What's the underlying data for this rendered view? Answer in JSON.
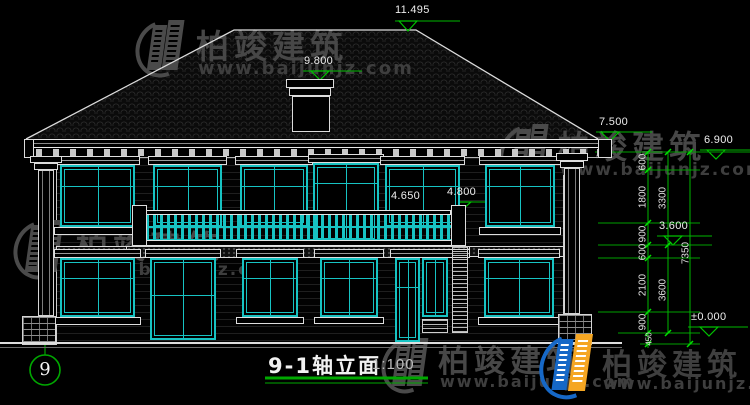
{
  "title_block": {
    "name": "9-1轴立面",
    "scale": "1:100"
  },
  "axis": {
    "number": "9"
  },
  "elevation_markers": {
    "ridge": "11.495",
    "chimney": "9.800",
    "eave": "7.500",
    "porch": "6.900",
    "second_floor": "3.600",
    "ground": "±0.000",
    "balcony_rail": "4.650",
    "balcony_pier": "4.800"
  },
  "dimension_chain": {
    "inner": [
      "600",
      "1800",
      "900",
      "600",
      "2100",
      "900",
      "450"
    ],
    "middle": [
      "3300",
      "3600"
    ],
    "overall": "7350"
  },
  "watermark": {
    "brand": "柏竣建筑",
    "url": "www.baijunjz.com"
  },
  "colors": {
    "line": "#e8e8e8",
    "window_frame": "#17c3c3",
    "dimension_green": "#00b800",
    "watermark_gray": "#474747",
    "logo_blue": "#1668c7"
  }
}
